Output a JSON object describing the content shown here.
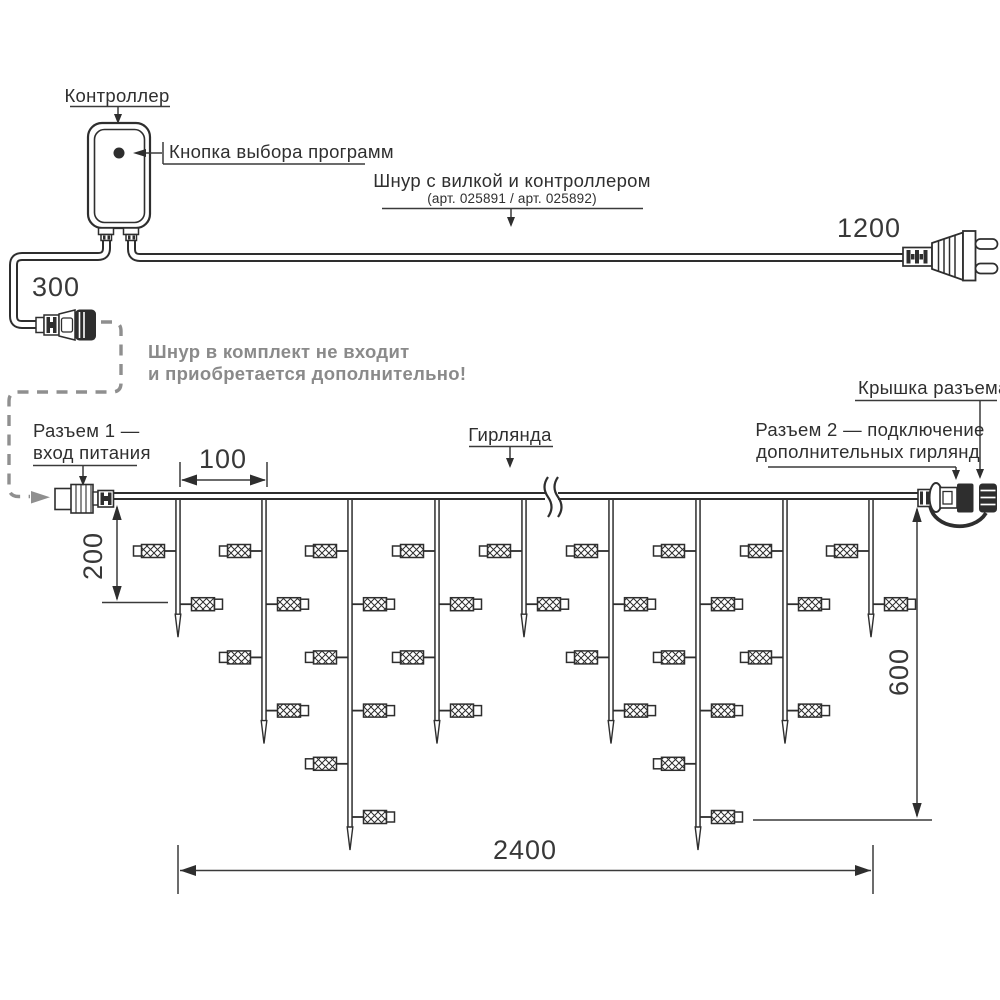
{
  "diagram": {
    "labels": {
      "controller": "Контроллер",
      "program_button": "Кнопка выбора программ",
      "cord_title": "Шнур с вилкой и контроллером",
      "cord_articles": "(арт. 025891 / арт. 025892)",
      "note_line1": "Шнур в комплект не входит",
      "note_line2": "и приобретается дополнительно!",
      "connector1_line1": "Разъем 1 —",
      "connector1_line2": "вход питания",
      "garland": "Гирлянда",
      "connector2_line1": "Разъем 2 — подключение",
      "connector2_line2": "дополнительных гирлянд",
      "cap": "Крышка разъема"
    },
    "dimensions": {
      "pigtail_length": "300",
      "cord_length": "1200",
      "drop_spacing": "100",
      "short_drop_length": "200",
      "long_drop_length": "600",
      "garland_length": "2400"
    },
    "colors": {
      "line": "#2e2e2e",
      "note_gray": "#8a8a8a",
      "dashed_gray": "#8f8f8f"
    },
    "garland": {
      "wire_y": 496,
      "lamp_first_y": 551,
      "lamp_step": 53.2,
      "tip_extra": 33,
      "drops": [
        {
          "x": 178,
          "lamps": 2
        },
        {
          "x": 264,
          "lamps": 4
        },
        {
          "x": 350,
          "lamps": 6
        },
        {
          "x": 437,
          "lamps": 4
        },
        {
          "x": 524,
          "lamps": 2
        },
        {
          "x": 611,
          "lamps": 4
        },
        {
          "x": 698,
          "lamps": 6
        },
        {
          "x": 785,
          "lamps": 4
        },
        {
          "x": 871,
          "lamps": 2
        }
      ]
    }
  }
}
